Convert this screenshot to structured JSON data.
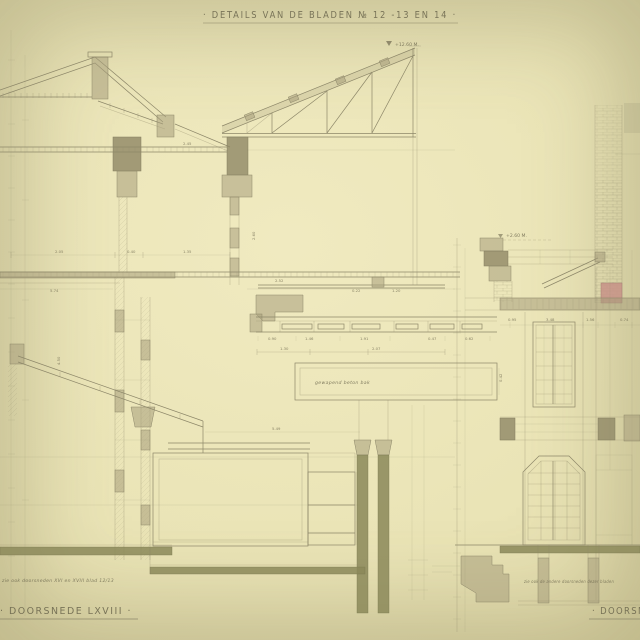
{
  "page": {
    "title": "· DETAILS VAN DE BLADEN № 12 -13 EN 14 ·"
  },
  "left_section": {
    "note": "zie ook doorsneden XVI en XVIII blad 12/13",
    "caption": "· DOORSNEDE LXVIII ·",
    "level_mark": "+12.60 M."
  },
  "right_section": {
    "note": "zie ook de andere doorsneden dezer bladen",
    "caption": "· DOORSNEDE",
    "level_mark": "+2.60 M."
  },
  "panel": {
    "inscription": "gewapend beton bak"
  },
  "dims": {
    "d1": "5.74",
    "d2": "2.05",
    "d3": "0.40",
    "d4": "1.35",
    "d5": "2.45",
    "d6": "5.49",
    "d7": "2.07",
    "d8": "1.30",
    "d9": "4.50",
    "d10": "2.60",
    "d11": "0.95",
    "d12": "3.48",
    "d13": "1.56",
    "d14": "0.74",
    "d15": "0.22",
    "d16": "1.20",
    "d17": "0.90",
    "d18": "1.46",
    "d19": "1.91",
    "d20": "0.47",
    "d21": "0.62",
    "d22": "0.42",
    "d23": "2.52"
  }
}
